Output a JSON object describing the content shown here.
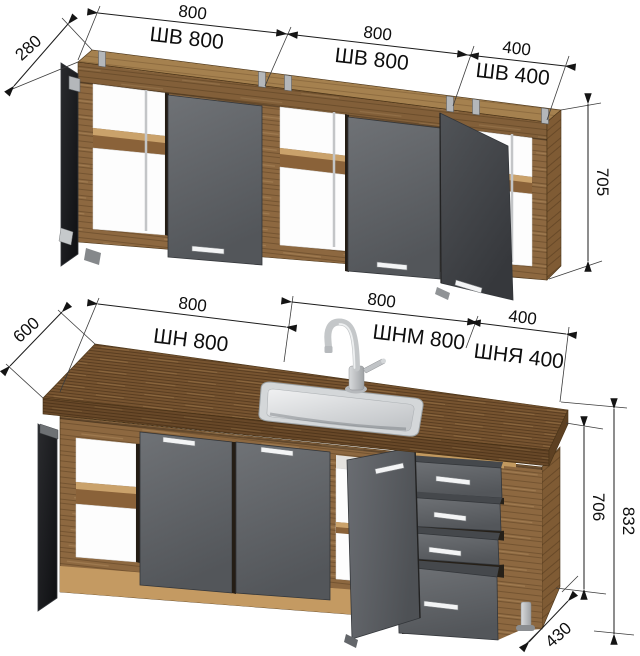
{
  "wall_section": {
    "depth": "280",
    "height": "705",
    "cabinets": [
      {
        "width": "800",
        "name": "ШВ 800"
      },
      {
        "width": "800",
        "name": "ШВ 800"
      },
      {
        "width": "400",
        "name": "ШВ 400"
      }
    ]
  },
  "base_section": {
    "depth": "600",
    "cabinet_height": "706",
    "total_height": "832",
    "bottom_depth": "430",
    "cabinets": [
      {
        "width": "800",
        "name": "ШН 800"
      },
      {
        "width": "800",
        "name": "ШНМ 800"
      },
      {
        "width": "400",
        "name": "ШНЯ 400"
      }
    ]
  },
  "colors": {
    "wood": "#8d6840",
    "countertop": "#775430",
    "plinth": "#c49a62",
    "door_gray": "#5f6266",
    "dimension_lines": "#1b1b1b",
    "background": "#ffffff"
  }
}
